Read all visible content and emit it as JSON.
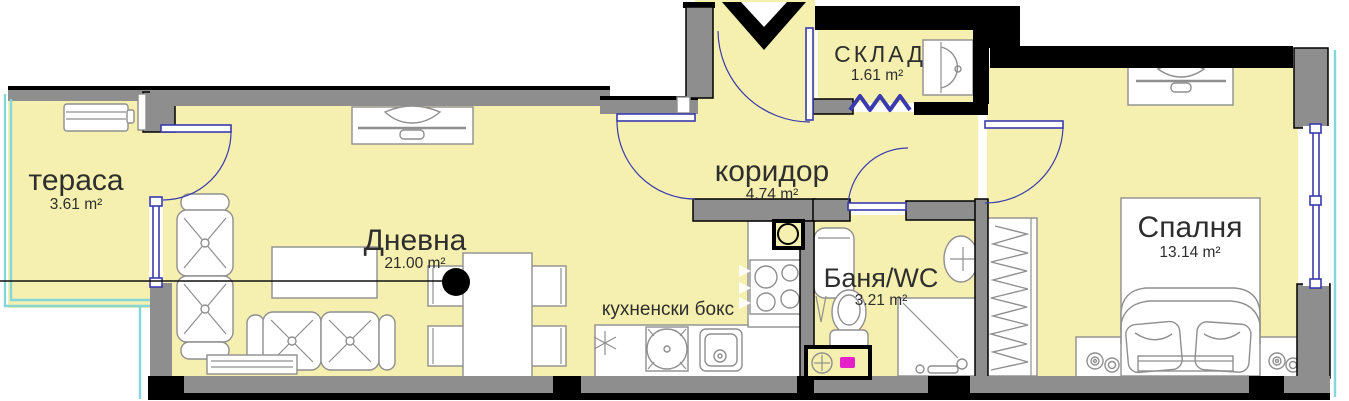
{
  "plan": {
    "title": "apartment-floor-plan",
    "rooms": [
      {
        "name": "тераса",
        "area": "3.61 m²"
      },
      {
        "name": "Дневна",
        "area": "21.00 m²"
      },
      {
        "name": "коридор",
        "area": "4.74 m²"
      },
      {
        "name": "СКЛАД",
        "area": "1.61 m²"
      },
      {
        "name": "Баня/WC",
        "area": "3.21 m²"
      },
      {
        "name": "Спалня",
        "area": "13.14 m²"
      },
      {
        "name": "кухненски бокс"
      }
    ]
  },
  "colors": {
    "room_fill": "#F5F0AF",
    "wall_gray": "#8E8E8E",
    "outline_black": "#000000",
    "door_blue": "#3A3AAE",
    "railing_cyan": "#85D6DA",
    "accent_magenta": "#E620C8",
    "furniture_stroke": "#8F8F8F",
    "label_text": "#2E2E2E"
  },
  "icons": [
    "entrance-arrow-icon",
    "folding-door-icon",
    "ac-unit-icon",
    "tv-icon",
    "sofa-icon",
    "coffee-table-icon",
    "dining-table-icon",
    "chair-icon",
    "fridge-star-icon",
    "hob-icon",
    "kitchen-sink-icon",
    "stove-icon",
    "vent-shaft-icon",
    "boiler-icon",
    "toilet-icon",
    "bath-sink-icon",
    "shower-icon",
    "washing-machine-icon",
    "wardrobe-icon",
    "bed-icon",
    "pillow-icon",
    "lamp-icon",
    "section-marker-icon",
    "window-icon",
    "door-swing-icon"
  ]
}
